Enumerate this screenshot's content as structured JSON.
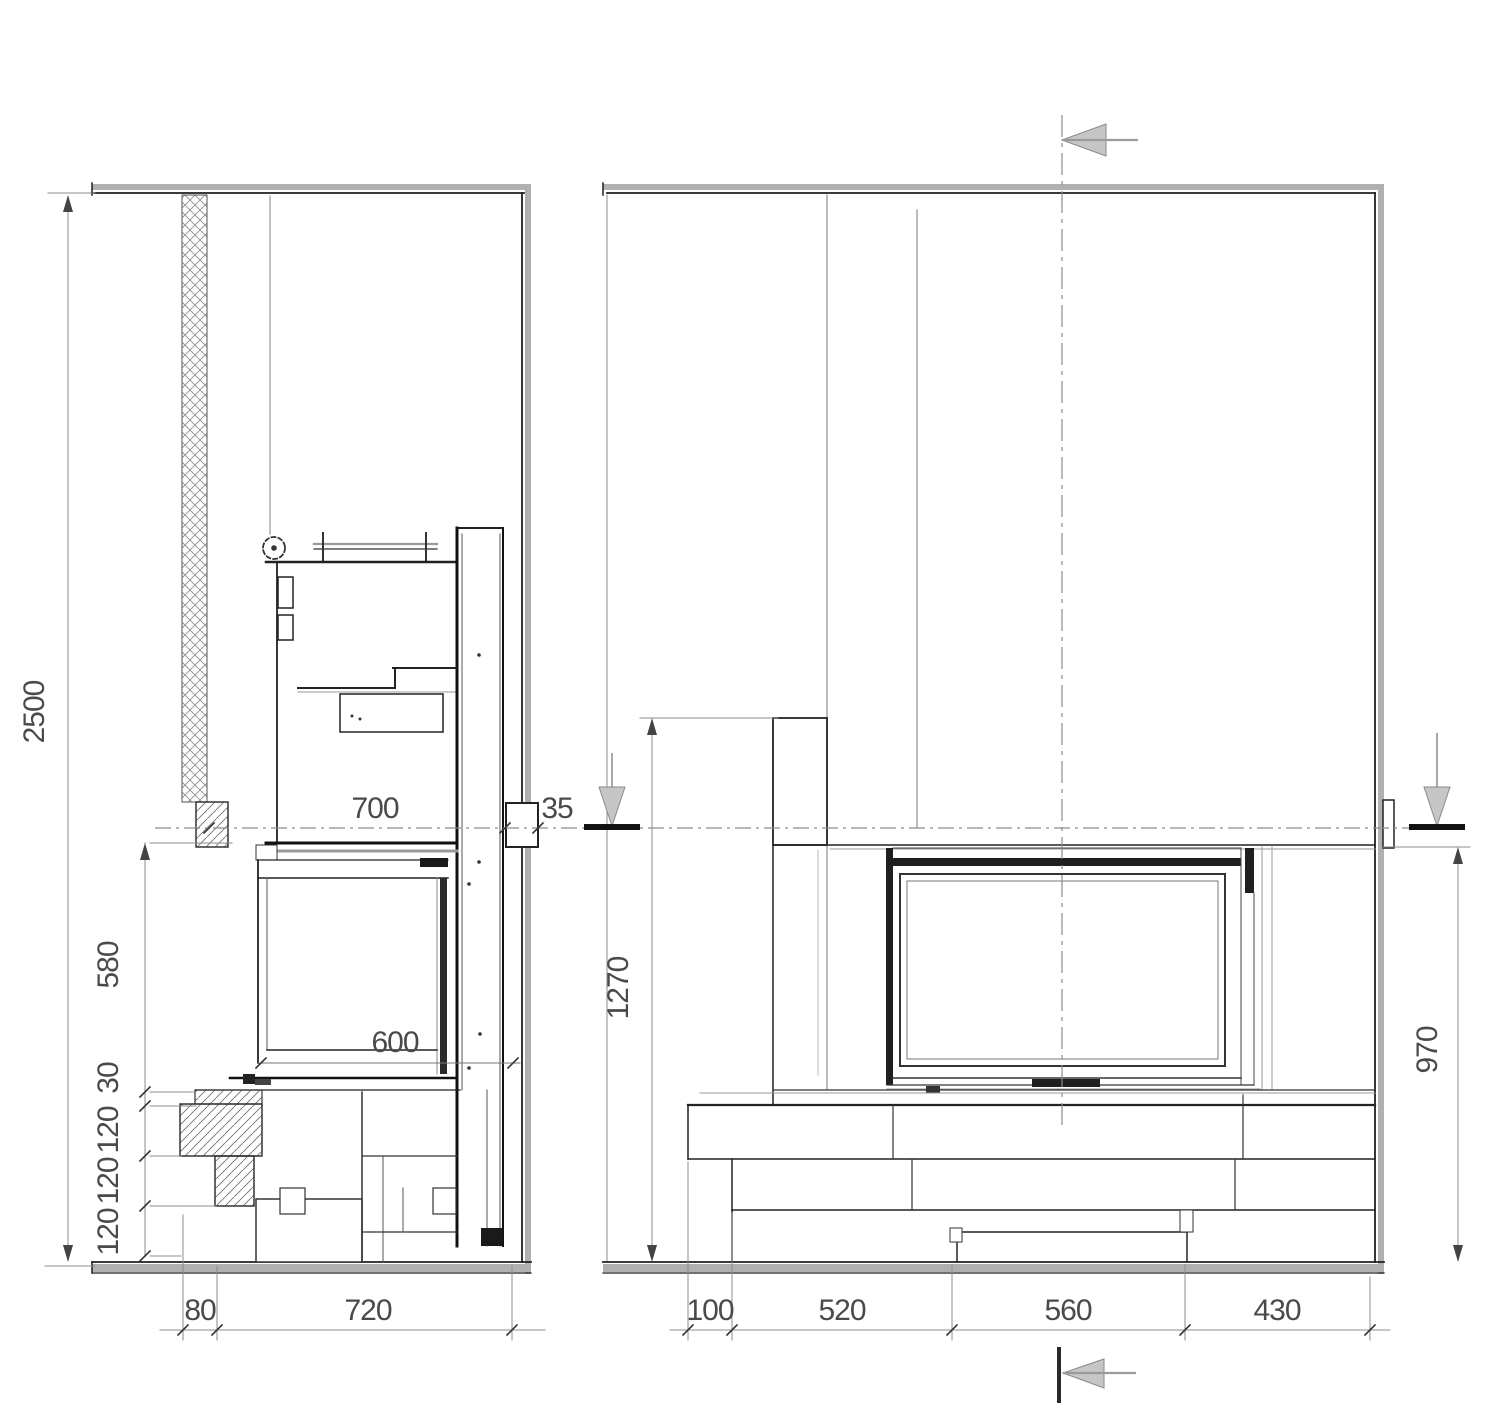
{
  "left_view": {
    "overall_height": "2500",
    "height_chain": [
      "580",
      "30",
      "120",
      "120",
      "120"
    ],
    "width_chain": [
      "80",
      "720"
    ],
    "depth_upper": "700",
    "depth_firebox": "600",
    "wall_offset": "35"
  },
  "right_view": {
    "pillar_height": "1270",
    "bench_height": "970",
    "width_chain": [
      "100",
      "520",
      "560",
      "430"
    ]
  },
  "colors": {
    "line_dark": "#1f1f1f",
    "line_gray": "#8c8c8c",
    "band_gray": "#b0b0b0",
    "arrow_fill": "#c6c6c6",
    "dim_text": "#4a4a4a"
  }
}
